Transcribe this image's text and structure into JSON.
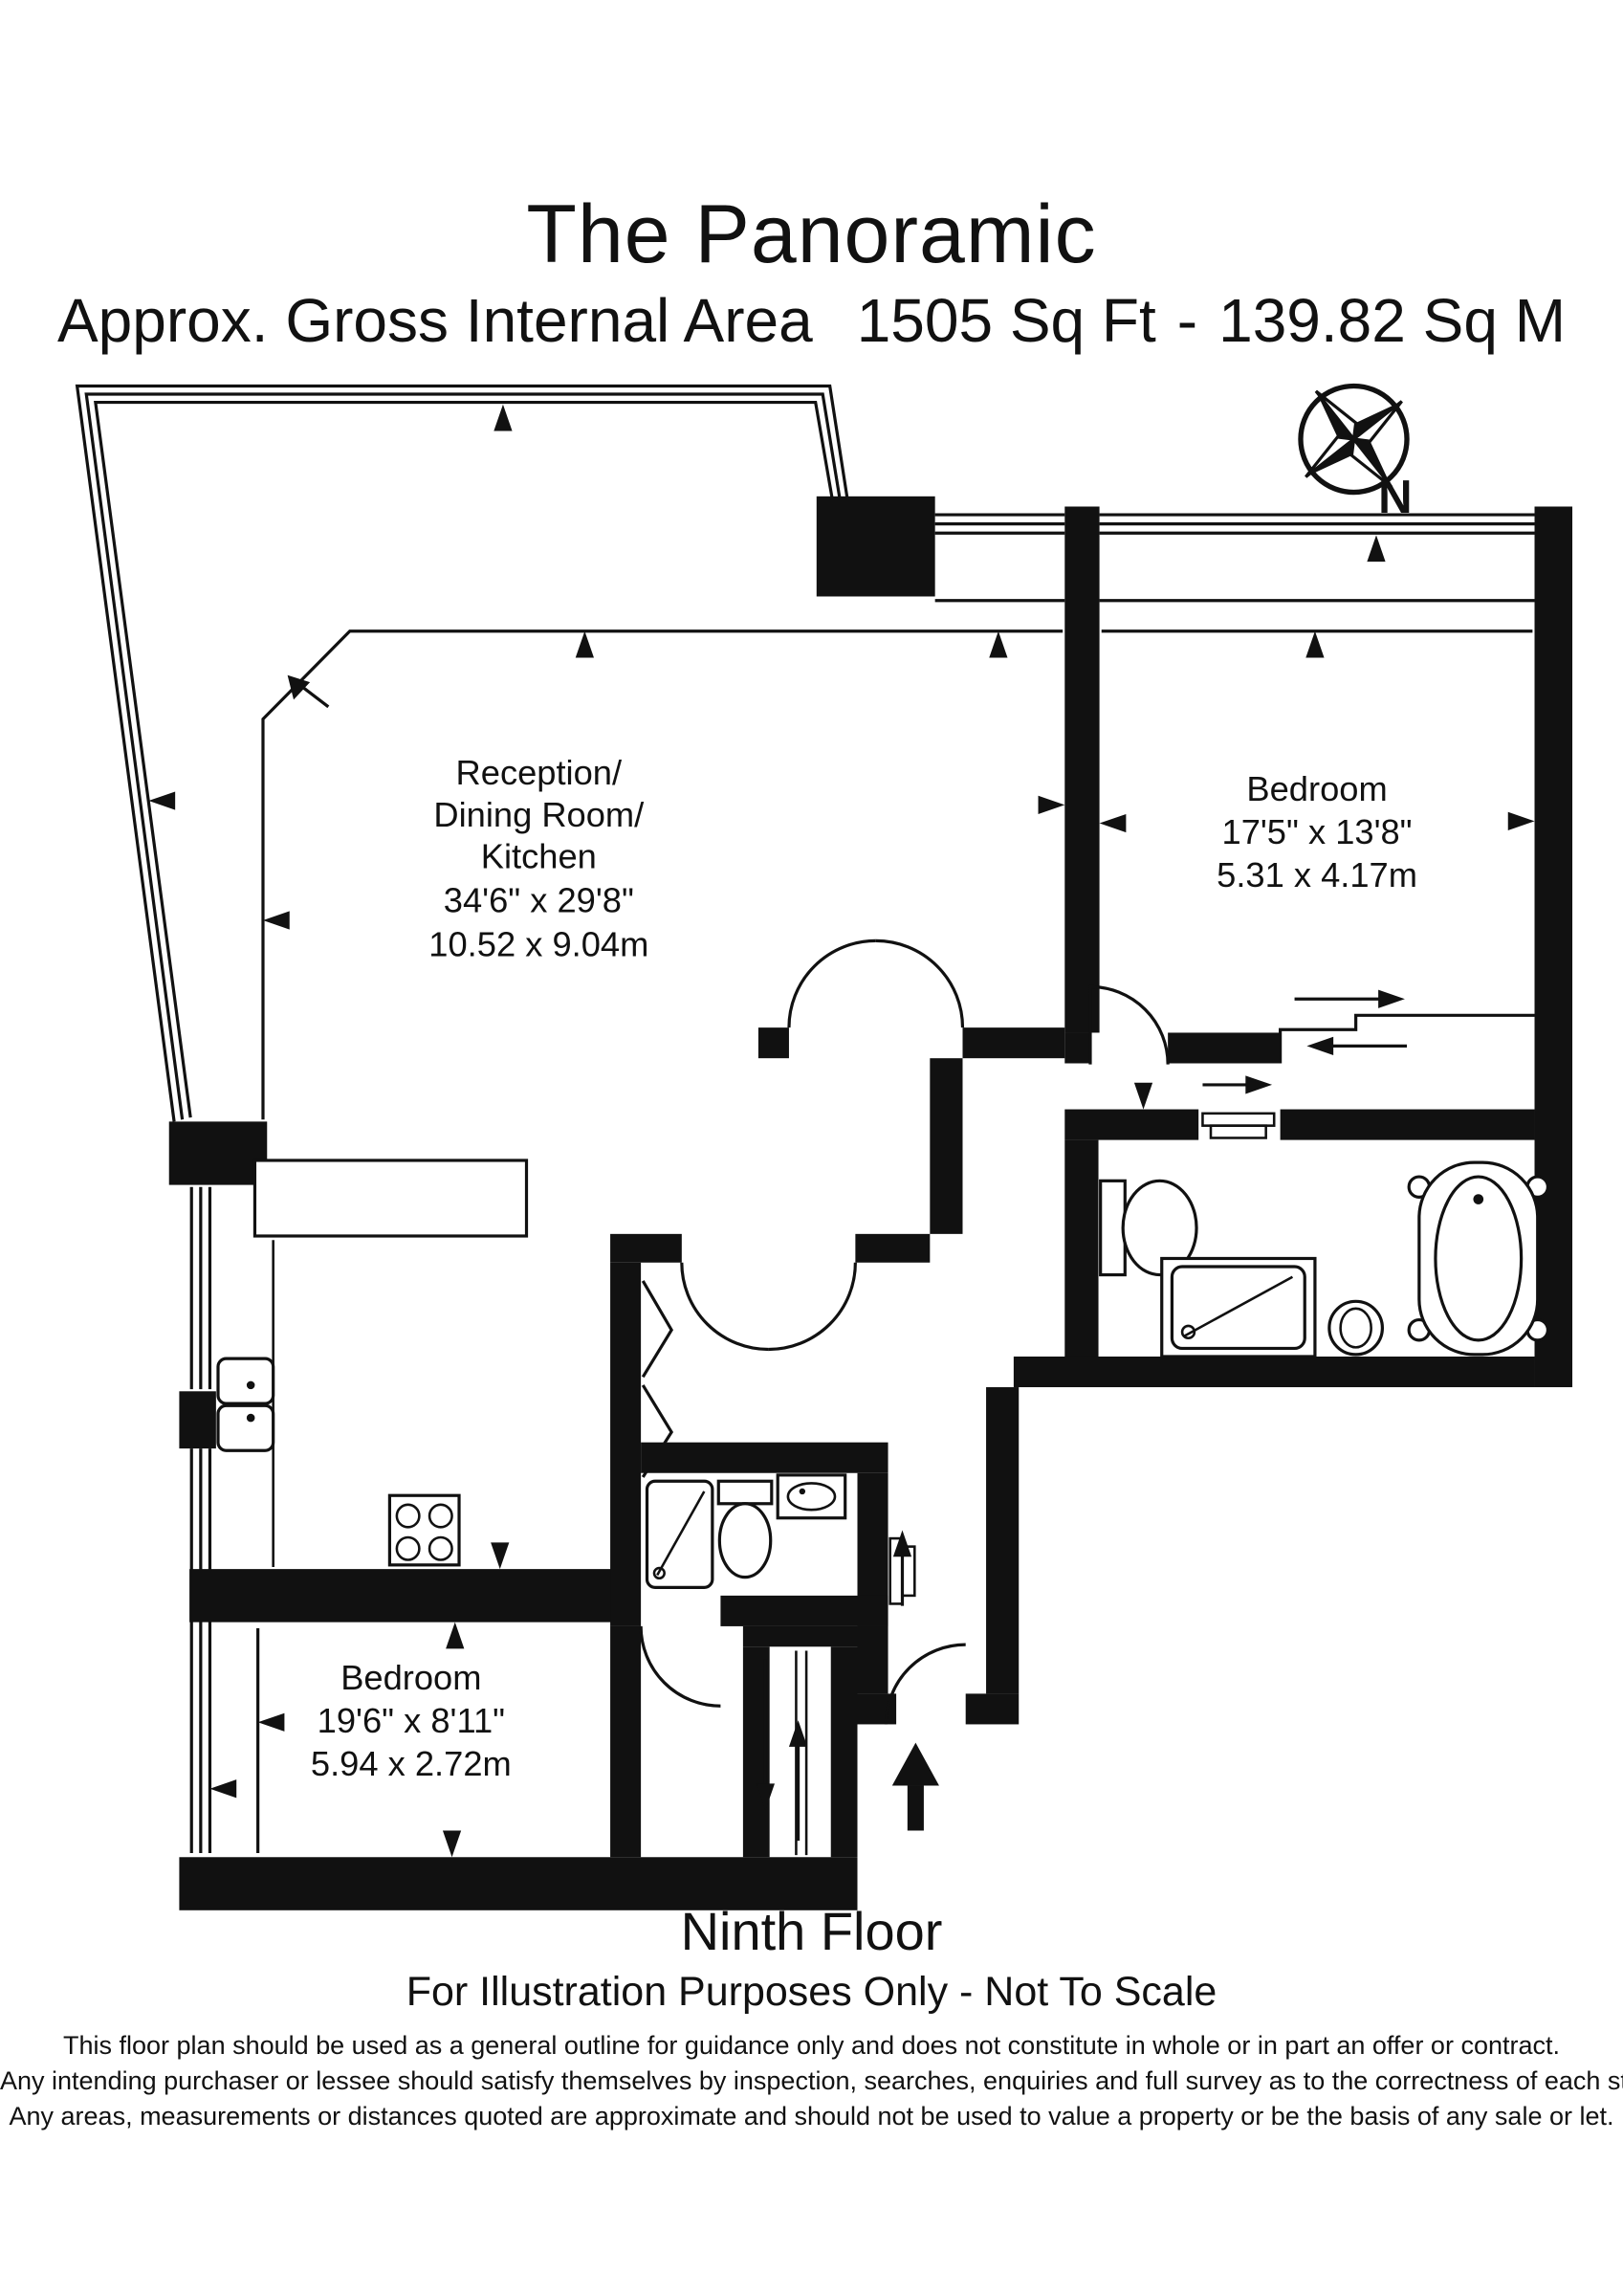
{
  "header": {
    "title": "The Panoramic",
    "area_label": "Approx. Gross Internal Area",
    "area_imperial": "1505 Sq Ft",
    "separator": "-",
    "area_metric": "139.82 Sq M"
  },
  "compass": {
    "label": "N"
  },
  "rooms": {
    "reception": {
      "name_lines": [
        "Reception/",
        "Dining Room/",
        "Kitchen"
      ],
      "dim_imperial": "34'6\" x 29'8\"",
      "dim_metric": "10.52 x 9.04m"
    },
    "bedroom_right": {
      "name": "Bedroom",
      "dim_imperial": "17'5\" x 13'8\"",
      "dim_metric": "5.31 x 4.17m"
    },
    "bedroom_bottom": {
      "name": "Bedroom",
      "dim_imperial": "19'6\" x 8'11\"",
      "dim_metric": "5.94 x 2.72m"
    }
  },
  "footer": {
    "floor": "Ninth Floor",
    "scale_note": "For Illustration Purposes Only - Not To Scale",
    "disclaimer_lines": [
      "This floor plan should be used as a general outline for guidance only and does not constitute in whole or in part an offer or contract.",
      "Any intending purchaser or lessee should satisfy themselves by inspection, searches, enquiries and full survey as to the correctness of each statement.",
      "Any areas, measurements or distances quoted are approximate and should not be used to value a property or be the basis of any sale or let."
    ]
  },
  "fixtures": [
    "compass-rose-icon",
    "bath-icon",
    "toilet-icon",
    "shower-icon",
    "basin-icon",
    "kitchen-sink-icon",
    "hob-icon",
    "kitchen-island-icon",
    "entrance-arrow-icon",
    "wardrobe-sliding-arrows",
    "dimension-arrows"
  ],
  "colors": {
    "ink": "#111111",
    "background": "#ffffff"
  }
}
